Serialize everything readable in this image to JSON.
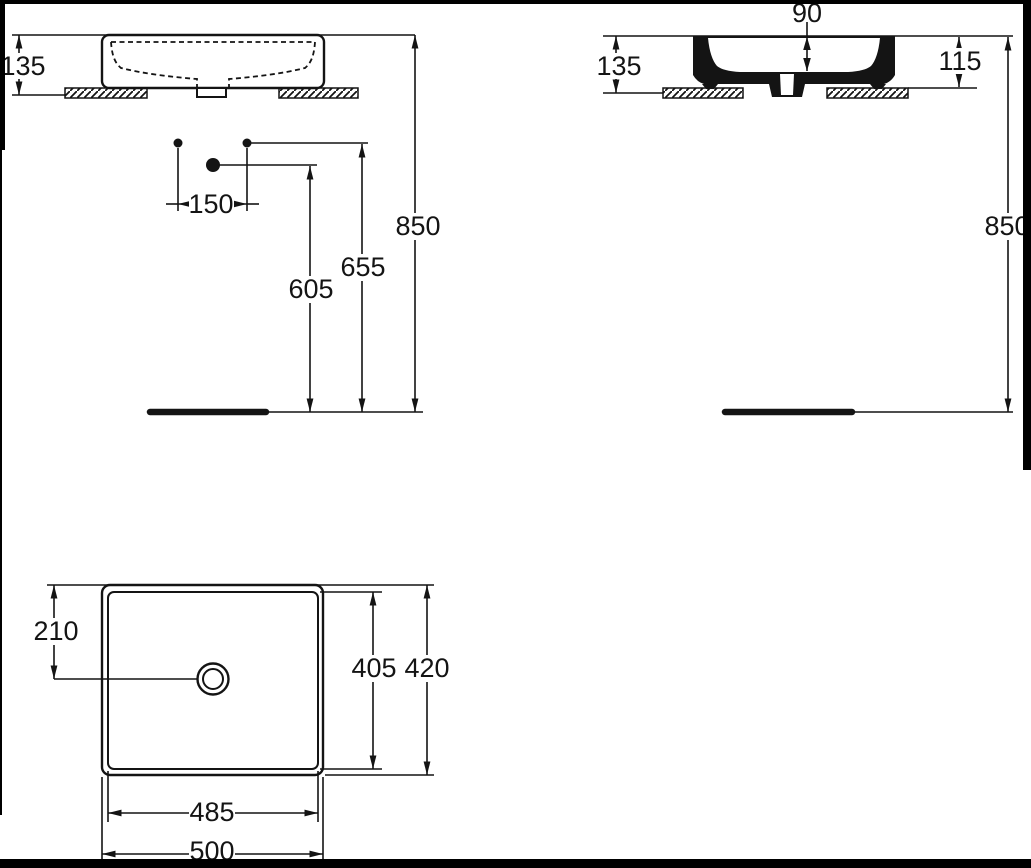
{
  "colors": {
    "line": "#141414",
    "background": "#ffffff",
    "frame": "#000000"
  },
  "views": {
    "front_elevation": {
      "dimensions": {
        "basin_height": "135",
        "fixture_spacing": "150",
        "waste_outlet_height": "605",
        "supply_height": "655",
        "rim_height": "850"
      }
    },
    "side_section": {
      "dimensions": {
        "bowl_depth": "90",
        "basin_height": "135",
        "height_above_counter": "115",
        "rim_height": "850"
      }
    },
    "plan": {
      "dimensions": {
        "drain_center_offset": "210",
        "inner_depth": "405",
        "overall_depth": "420",
        "inner_width": "485",
        "overall_width": "500"
      }
    }
  }
}
